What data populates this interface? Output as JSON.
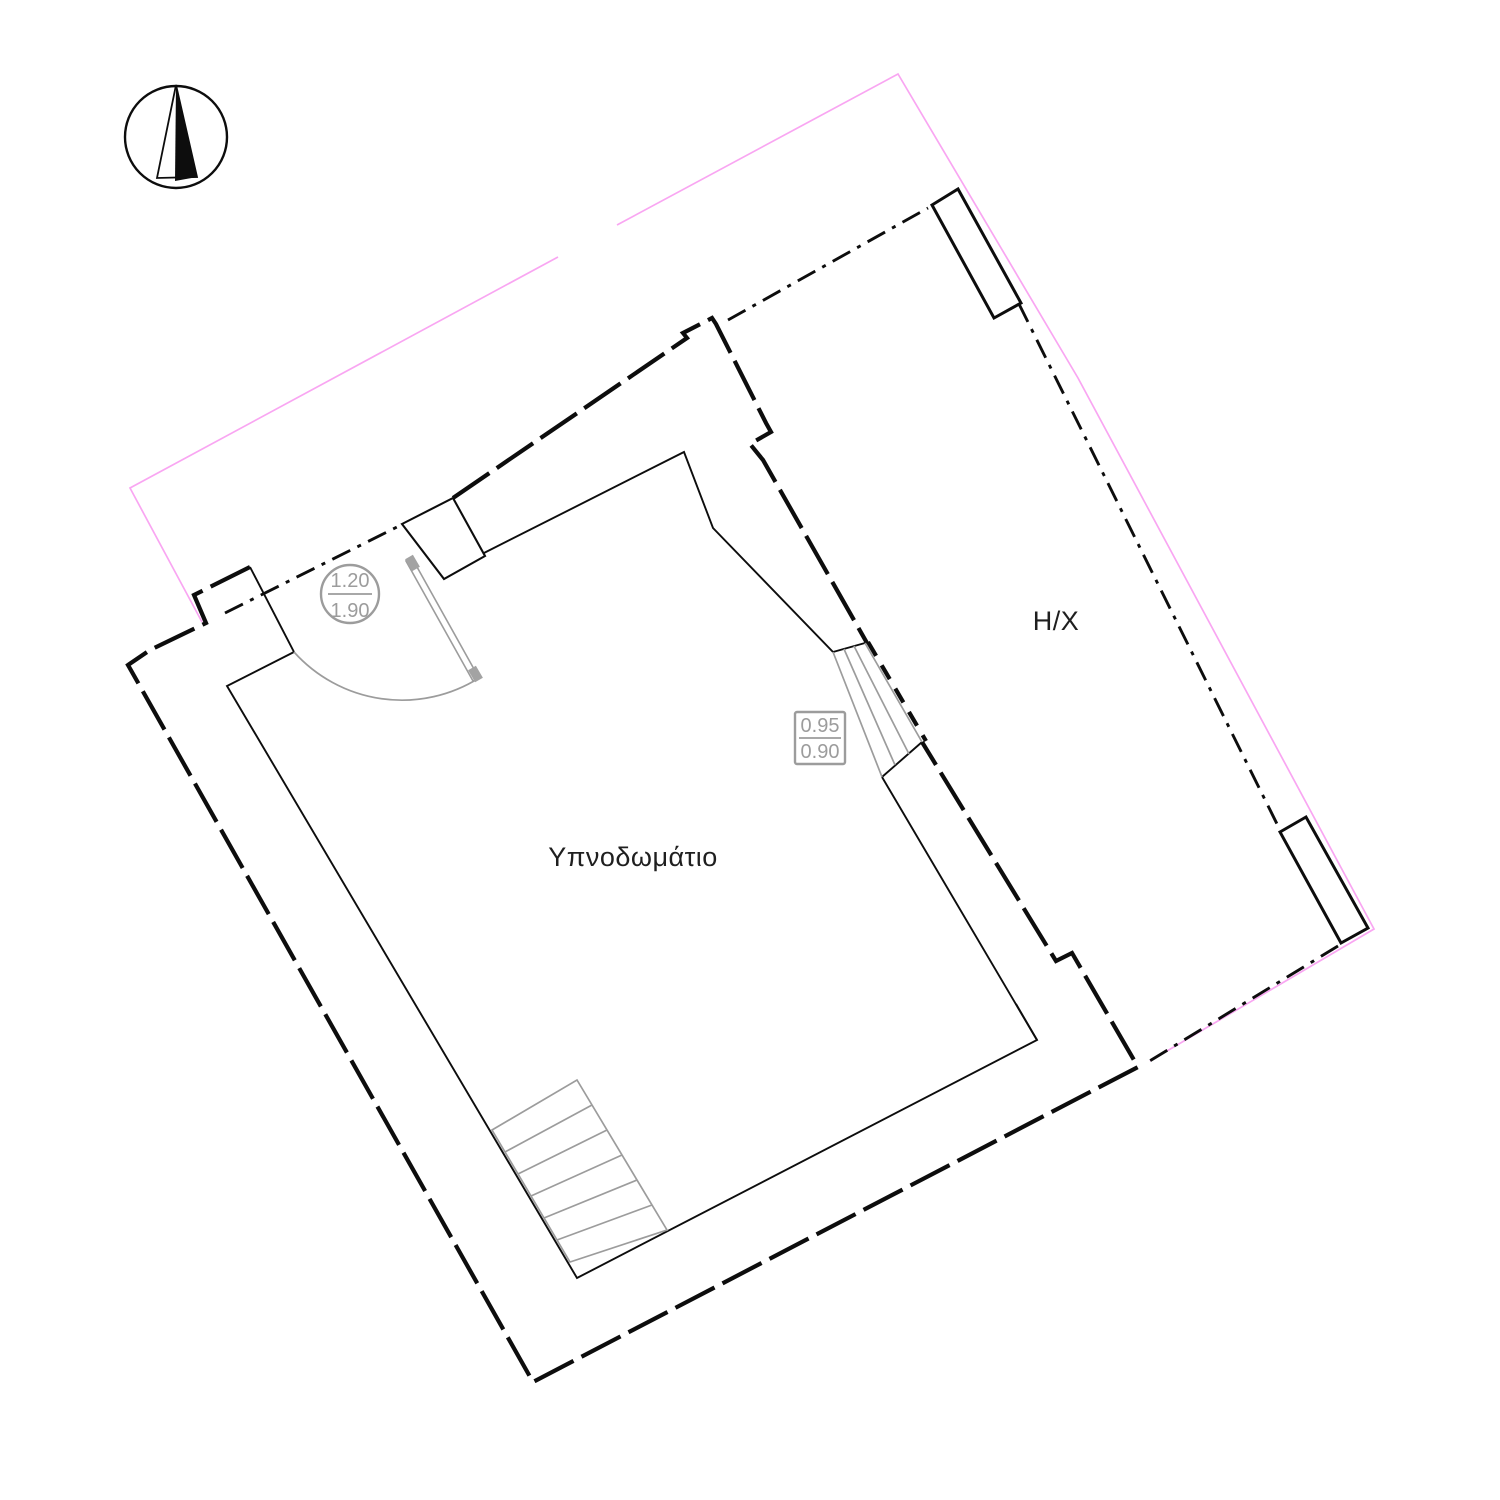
{
  "labels": {
    "room": "Υπνοδωμάτιο",
    "covered_area": "Η/Χ"
  },
  "door_dimension": {
    "width": "1.20",
    "height": "1.90"
  },
  "window_dimension": {
    "width": "0.95",
    "height": "0.90"
  },
  "icons": {
    "north_arrow": "north-arrow-compass"
  },
  "colors": {
    "boundary-pink": "#f9a6f2",
    "line-black": "#0d0d0d",
    "annotation-gray": "#9c9c9c",
    "door-cap-gray": "#a3a3a3",
    "label-dark": "#1f1f1f",
    "background": "#ffffff"
  }
}
